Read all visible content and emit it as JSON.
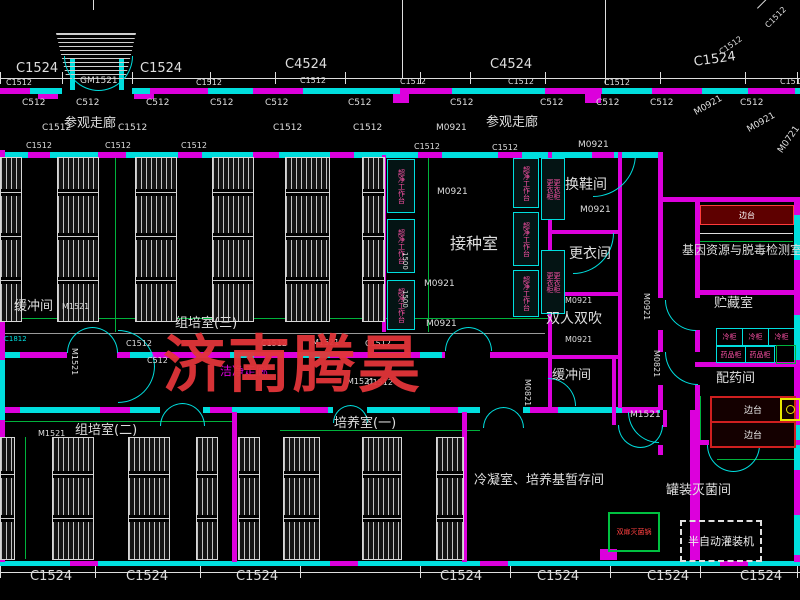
{
  "meta": {
    "drawing_type": "floor-plan"
  },
  "watermark": {
    "text": "济南腾昊",
    "x": 163,
    "y": 334,
    "size": 62,
    "color": "#e23539"
  },
  "colors": {
    "cy": "#00dede",
    "mg": "#dc00dc",
    "wh": "#dedede",
    "gr": "#00b23c",
    "rd": "#e03238",
    "pk": "#ff52a8",
    "yl": "#e8e800",
    "gy": "#9a9a9a"
  },
  "rooms": [
    "参观走廊",
    "换鞋间",
    "更衣间",
    "接种室",
    "双人双吹",
    "缓冲间",
    "组培室(三)",
    "组培室(二)",
    "培养室(一)",
    "洁净走廊",
    "冷凝室、培养基暂存间",
    "基因资源与脱毒检测室",
    "贮藏室",
    "配药间",
    "罐装灭菌间"
  ],
  "walls": [
    [
      0,
      88,
      62,
      6,
      "cy"
    ],
    [
      132,
      88,
      668,
      6,
      "cy"
    ],
    [
      0,
      88,
      30,
      6,
      "mg"
    ],
    [
      150,
      88,
      58,
      6,
      "mg"
    ],
    [
      253,
      88,
      50,
      6,
      "mg"
    ],
    [
      400,
      88,
      52,
      6,
      "mg"
    ],
    [
      545,
      88,
      57,
      6,
      "mg"
    ],
    [
      652,
      88,
      50,
      6,
      "mg"
    ],
    [
      748,
      88,
      47,
      6,
      "mg"
    ],
    [
      38,
      94,
      20,
      5,
      "mg"
    ],
    [
      134,
      94,
      20,
      5,
      "mg"
    ],
    [
      393,
      94,
      16,
      9,
      "mg"
    ],
    [
      585,
      94,
      16,
      9,
      "mg"
    ],
    [
      0,
      152,
      658,
      6,
      "cy"
    ],
    [
      28,
      152,
      22,
      6,
      "mg"
    ],
    [
      98,
      152,
      28,
      6,
      "mg"
    ],
    [
      178,
      152,
      24,
      6,
      "mg"
    ],
    [
      253,
      152,
      26,
      6,
      "mg"
    ],
    [
      330,
      152,
      24,
      6,
      "mg"
    ],
    [
      418,
      152,
      24,
      6,
      "mg"
    ],
    [
      498,
      152,
      24,
      6,
      "mg"
    ],
    [
      592,
      152,
      22,
      6,
      "mg"
    ],
    [
      0,
      352,
      67,
      6,
      "mg"
    ],
    [
      117,
      352,
      328,
      6,
      "mg"
    ],
    [
      490,
      352,
      58,
      6,
      "mg"
    ],
    [
      0,
      352,
      20,
      6,
      "cy"
    ],
    [
      130,
      352,
      22,
      6,
      "cy"
    ],
    [
      230,
      352,
      24,
      6,
      "cy"
    ],
    [
      300,
      352,
      30,
      6,
      "cy"
    ],
    [
      420,
      352,
      22,
      6,
      "cy"
    ],
    [
      0,
      407,
      160,
      6,
      "cy"
    ],
    [
      203,
      407,
      130,
      6,
      "cy"
    ],
    [
      367,
      407,
      113,
      6,
      "cy"
    ],
    [
      523,
      407,
      137,
      6,
      "cy"
    ],
    [
      0,
      407,
      20,
      6,
      "mg"
    ],
    [
      100,
      407,
      30,
      6,
      "mg"
    ],
    [
      210,
      407,
      22,
      6,
      "mg"
    ],
    [
      300,
      407,
      28,
      6,
      "mg"
    ],
    [
      430,
      407,
      28,
      6,
      "mg"
    ],
    [
      530,
      407,
      28,
      6,
      "mg"
    ],
    [
      622,
      407,
      36,
      6,
      "mg"
    ],
    [
      0,
      561,
      800,
      5,
      "cy"
    ],
    [
      70,
      561,
      28,
      5,
      "mg"
    ],
    [
      330,
      561,
      28,
      5,
      "mg"
    ],
    [
      480,
      561,
      28,
      5,
      "mg"
    ],
    [
      720,
      561,
      28,
      5,
      "mg"
    ],
    [
      58,
      549,
      22,
      11,
      "mg"
    ],
    [
      600,
      549,
      17,
      11,
      "mg"
    ],
    [
      0,
      150,
      5,
      412,
      "mg"
    ],
    [
      0,
      170,
      5,
      60,
      "cy"
    ],
    [
      0,
      280,
      5,
      30,
      "cy"
    ],
    [
      0,
      360,
      5,
      60,
      "cy"
    ],
    [
      0,
      470,
      5,
      50,
      "cy"
    ],
    [
      794,
      197,
      6,
      365,
      "mg"
    ],
    [
      794,
      215,
      6,
      45,
      "cy"
    ],
    [
      794,
      315,
      6,
      45,
      "cy"
    ],
    [
      794,
      425,
      6,
      45,
      "cy"
    ],
    [
      794,
      515,
      6,
      40,
      "cy"
    ],
    [
      658,
      152,
      5,
      146,
      "mg"
    ],
    [
      658,
      330,
      5,
      22,
      "mg"
    ],
    [
      658,
      385,
      5,
      25,
      "mg"
    ],
    [
      658,
      445,
      5,
      10,
      "mg"
    ],
    [
      695,
      197,
      5,
      101,
      "mg"
    ],
    [
      695,
      330,
      5,
      22,
      "mg"
    ],
    [
      695,
      385,
      5,
      175,
      "mg"
    ],
    [
      690,
      410,
      5,
      152,
      "mg"
    ],
    [
      660,
      197,
      140,
      5,
      "mg"
    ],
    [
      695,
      290,
      105,
      5,
      "mg"
    ],
    [
      695,
      362,
      105,
      5,
      "mg"
    ],
    [
      695,
      440,
      14,
      5,
      "mg"
    ],
    [
      757,
      440,
      43,
      5,
      "mg"
    ],
    [
      548,
      152,
      4,
      256,
      "mg"
    ],
    [
      618,
      152,
      4,
      256,
      "mg"
    ],
    [
      548,
      230,
      72,
      4,
      "mg"
    ],
    [
      548,
      292,
      72,
      4,
      "mg"
    ],
    [
      548,
      355,
      72,
      4,
      "mg"
    ],
    [
      382,
      155,
      4,
      177,
      "mg"
    ],
    [
      232,
      412,
      5,
      150,
      "mg"
    ],
    [
      462,
      412,
      5,
      150,
      "mg"
    ],
    [
      612,
      357,
      4,
      68,
      "mg"
    ],
    [
      663,
      410,
      4,
      17,
      "mg"
    ],
    [
      70,
      58,
      5,
      32,
      "cy"
    ],
    [
      119,
      58,
      5,
      32,
      "cy"
    ]
  ],
  "lines": [
    [
      0,
      78,
      800,
      1,
      "wh"
    ],
    [
      0,
      572,
      800,
      1,
      "wh"
    ],
    [
      0,
      72,
      1,
      12,
      "wh"
    ],
    [
      62,
      72,
      1,
      12,
      "wh"
    ],
    [
      132,
      72,
      1,
      12,
      "wh"
    ],
    [
      210,
      72,
      1,
      12,
      "wh"
    ],
    [
      275,
      72,
      1,
      12,
      "wh"
    ],
    [
      345,
      72,
      1,
      12,
      "wh"
    ],
    [
      420,
      72,
      1,
      12,
      "wh"
    ],
    [
      470,
      72,
      1,
      12,
      "wh"
    ],
    [
      545,
      72,
      1,
      12,
      "wh"
    ],
    [
      605,
      72,
      1,
      12,
      "wh"
    ],
    [
      660,
      72,
      1,
      12,
      "wh"
    ],
    [
      745,
      72,
      1,
      12,
      "wh"
    ],
    [
      797,
      72,
      1,
      12,
      "wh"
    ],
    [
      402,
      0,
      1,
      78,
      "wh"
    ],
    [
      605,
      0,
      1,
      78,
      "wh"
    ],
    [
      93,
      0,
      1,
      10,
      "wh"
    ],
    [
      757,
      8,
      55,
      1,
      "wh",
      -45
    ],
    [
      0,
      566,
      1,
      12,
      "wh"
    ],
    [
      95,
      566,
      1,
      12,
      "wh"
    ],
    [
      200,
      566,
      1,
      12,
      "wh"
    ],
    [
      300,
      566,
      1,
      12,
      "wh"
    ],
    [
      420,
      566,
      1,
      12,
      "wh"
    ],
    [
      510,
      566,
      1,
      12,
      "wh"
    ],
    [
      610,
      566,
      1,
      12,
      "wh"
    ],
    [
      700,
      566,
      1,
      12,
      "wh"
    ],
    [
      797,
      566,
      1,
      12,
      "wh"
    ],
    [
      0,
      318,
      548,
      1,
      "gr"
    ],
    [
      0,
      421,
      232,
      1,
      "gr"
    ],
    [
      280,
      430,
      200,
      1,
      "gr"
    ],
    [
      115,
      157,
      1,
      175,
      "gr"
    ],
    [
      428,
      155,
      1,
      177,
      "gr"
    ],
    [
      25,
      437,
      1,
      122,
      "gr"
    ],
    [
      700,
      396,
      1,
      46,
      "gr"
    ],
    [
      717,
      459,
      82,
      1,
      "gr"
    ],
    [
      0,
      333,
      545,
      1,
      "gy"
    ],
    [
      697,
      233,
      96,
      1,
      "wh"
    ],
    [
      697,
      241,
      96,
      1,
      "gr"
    ]
  ],
  "racks": [
    [
      0,
      157,
      20,
      163
    ],
    [
      57,
      157,
      40,
      163
    ],
    [
      135,
      157,
      40,
      163
    ],
    [
      212,
      157,
      40,
      163
    ],
    [
      285,
      157,
      43,
      163
    ],
    [
      362,
      157,
      21,
      163
    ],
    [
      0,
      437,
      13,
      121
    ],
    [
      52,
      437,
      40,
      121
    ],
    [
      128,
      437,
      40,
      121
    ],
    [
      196,
      437,
      20,
      121
    ],
    [
      238,
      437,
      20,
      121
    ],
    [
      283,
      437,
      35,
      121
    ],
    [
      362,
      437,
      38,
      121
    ],
    [
      436,
      437,
      26,
      121
    ]
  ],
  "clean_benches": {
    "label": "超净工作台",
    "boxes": [
      [
        387,
        159,
        26,
        52
      ],
      [
        387,
        219,
        26,
        52
      ],
      [
        387,
        280,
        26,
        48
      ],
      [
        513,
        158,
        24,
        48
      ],
      [
        513,
        212,
        24,
        52
      ],
      [
        513,
        270,
        24,
        45
      ]
    ]
  },
  "lockers": {
    "label": "更衣柜",
    "boxes": [
      [
        541,
        158,
        22,
        60
      ],
      [
        541,
        250,
        22,
        62
      ]
    ]
  },
  "doors_single": [
    [
      593,
      154,
      42,
      "se"
    ],
    [
      573,
      233,
      40,
      "se"
    ],
    [
      548,
      378,
      27,
      "ne"
    ],
    [
      665,
      300,
      30,
      "sw"
    ],
    [
      665,
      352,
      32,
      "sw"
    ],
    [
      628,
      412,
      30,
      "sw"
    ]
  ],
  "doors_double": [
    [
      64,
      56,
      34,
      "down"
    ],
    [
      67,
      327,
      25,
      "up"
    ],
    [
      118,
      330,
      36,
      "right"
    ],
    [
      160,
      403,
      22,
      "up"
    ],
    [
      333,
      405,
      17,
      "up"
    ],
    [
      445,
      327,
      23,
      "up"
    ],
    [
      483,
      407,
      20,
      "up"
    ],
    [
      618,
      425,
      22,
      "down"
    ],
    [
      707,
      445,
      26,
      "down"
    ]
  ],
  "equipment": {
    "red_band": {
      "x": 700,
      "y": 205,
      "w": 92,
      "h": 18,
      "label": "边台"
    },
    "red_benches": {
      "label": "边台",
      "boxes": [
        [
          710,
          396,
          82,
          23
        ],
        [
          710,
          421,
          82,
          23
        ]
      ]
    },
    "cold_cabinets": {
      "label": "冷柜",
      "boxes": [
        [
          716,
          328,
          25,
          16
        ],
        [
          742,
          328,
          25,
          16
        ],
        [
          768,
          328,
          25,
          16
        ]
      ]
    },
    "med_cabinets": {
      "label": "药品柜",
      "boxes": [
        [
          716,
          346,
          28,
          15
        ],
        [
          745,
          346,
          28,
          15
        ]
      ]
    },
    "green_box": {
      "x": 776,
      "y": 345,
      "w": 18,
      "h": 17
    },
    "sterilizer": {
      "x": 608,
      "y": 512,
      "w": 48,
      "h": 36,
      "label": "双扉灭菌锅"
    },
    "filler": {
      "x": 680,
      "y": 520,
      "w": 78,
      "h": 38,
      "label": "半自动灌装机"
    },
    "sink": {
      "x": 780,
      "y": 398,
      "w": 17,
      "h": 19
    },
    "canopy": {
      "x": 56,
      "y": 33,
      "w": 80,
      "h": 47
    }
  },
  "labels": [
    [
      "C1524",
      16,
      62,
      13
    ],
    [
      "C1524",
      140,
      62,
      13
    ],
    [
      "C4524",
      285,
      58,
      13
    ],
    [
      "C4524",
      490,
      58,
      13
    ],
    [
      "C1524",
      693,
      56,
      13,
      "wh",
      -8
    ],
    [
      "C1512",
      718,
      50,
      8,
      "wh",
      -35
    ],
    [
      "GM1521",
      80,
      77,
      9
    ],
    [
      "C1512",
      6,
      79,
      8
    ],
    [
      "C1512",
      196,
      79,
      8
    ],
    [
      "C1512",
      300,
      77,
      8
    ],
    [
      "C1512",
      400,
      78,
      8
    ],
    [
      "C1512",
      508,
      78,
      8
    ],
    [
      "C1512",
      604,
      79,
      8
    ],
    [
      "C1512",
      780,
      78,
      8
    ],
    [
      "C1512",
      764,
      24,
      8,
      "wh",
      -45
    ],
    [
      "C512",
      22,
      99,
      9
    ],
    [
      "C512",
      76,
      99,
      9
    ],
    [
      "C512",
      146,
      99,
      9
    ],
    [
      "C512",
      210,
      99,
      9
    ],
    [
      "C512",
      265,
      99,
      9
    ],
    [
      "C512",
      348,
      99,
      9
    ],
    [
      "C512",
      450,
      99,
      9
    ],
    [
      "C512",
      540,
      99,
      9
    ],
    [
      "C512",
      596,
      99,
      9
    ],
    [
      "C512",
      650,
      99,
      9
    ],
    [
      "C512",
      740,
      99,
      9
    ],
    [
      "C1512",
      42,
      124,
      9
    ],
    [
      "参观走廊",
      64,
      117,
      13
    ],
    [
      "C1512",
      118,
      124,
      9
    ],
    [
      "C1512",
      273,
      124,
      9
    ],
    [
      "C1512",
      353,
      124,
      9
    ],
    [
      "M0921",
      436,
      124,
      9
    ],
    [
      "参观走廊",
      486,
      116,
      13
    ],
    [
      "M0921",
      693,
      110,
      9,
      "wh",
      -30
    ],
    [
      "M0921",
      746,
      127,
      9,
      "wh",
      -30
    ],
    [
      "M0721",
      777,
      150,
      9,
      "wh",
      -55
    ],
    [
      "C1512",
      26,
      142,
      8
    ],
    [
      "C1512",
      105,
      142,
      8
    ],
    [
      "C1512",
      181,
      142,
      8
    ],
    [
      "C1512",
      414,
      143,
      8
    ],
    [
      "C1512",
      492,
      144,
      8
    ],
    [
      "M0921",
      578,
      141,
      9
    ],
    [
      "换鞋间",
      565,
      178,
      14
    ],
    [
      "M0921",
      580,
      206,
      9
    ],
    [
      "更衣间",
      569,
      247,
      14
    ],
    [
      "接种室",
      450,
      236,
      16
    ],
    [
      "M0921",
      437,
      188,
      9
    ],
    [
      "M0921",
      424,
      280,
      9
    ],
    [
      "M0921",
      426,
      320,
      9
    ],
    [
      "1500",
      408,
      252,
      7,
      "wh",
      90
    ],
    [
      "1500",
      408,
      290,
      7,
      "wh",
      90
    ],
    [
      "双人双吹",
      546,
      312,
      14
    ],
    [
      "M0921",
      565,
      297,
      8
    ],
    [
      "M0921",
      565,
      336,
      8
    ],
    [
      "缓冲间",
      552,
      369,
      13
    ],
    [
      "M0821",
      531,
      379,
      8,
      "wh",
      90
    ],
    [
      "M1521",
      630,
      411,
      9
    ],
    [
      "组培室(三)",
      175,
      317,
      13
    ],
    [
      "C1512",
      126,
      340,
      8
    ],
    [
      "C512",
      147,
      357,
      8
    ],
    [
      "C1512",
      261,
      340,
      8
    ],
    [
      "M1521",
      312,
      339,
      8
    ],
    [
      "C1512",
      365,
      340,
      8
    ],
    [
      "C1512",
      367,
      379,
      8
    ],
    [
      "M1521",
      347,
      378,
      8
    ],
    [
      "缓冲间",
      14,
      300,
      13
    ],
    [
      "M1521",
      62,
      303,
      8
    ],
    [
      "M1521",
      78,
      348,
      8,
      "wh",
      90
    ],
    [
      "C1812",
      4,
      336,
      7,
      "cy"
    ],
    [
      "洁净走廊",
      220,
      365,
      12,
      "mg"
    ],
    [
      "M0921",
      650,
      293,
      8,
      "wh",
      90
    ],
    [
      "M0821",
      660,
      350,
      8,
      "wh",
      90
    ],
    [
      "组培室(二)",
      75,
      424,
      13
    ],
    [
      "M1521",
      38,
      430,
      8
    ],
    [
      "培养室(一)",
      334,
      417,
      13
    ],
    [
      "冷凝室、培养基暂存间",
      474,
      474,
      13
    ],
    [
      "基因资源与脱毒检测室",
      682,
      244,
      12
    ],
    [
      "贮藏室",
      714,
      297,
      13
    ],
    [
      "配药间",
      716,
      372,
      13
    ],
    [
      "罐装灭菌间",
      666,
      484,
      13
    ],
    [
      "C1524",
      30,
      570,
      13
    ],
    [
      "C1524",
      126,
      570,
      13
    ],
    [
      "C1524",
      236,
      570,
      13
    ],
    [
      "C1524",
      440,
      570,
      13
    ],
    [
      "C1524",
      537,
      570,
      13
    ],
    [
      "C1524",
      647,
      570,
      13
    ],
    [
      "C1524",
      740,
      570,
      13
    ]
  ]
}
